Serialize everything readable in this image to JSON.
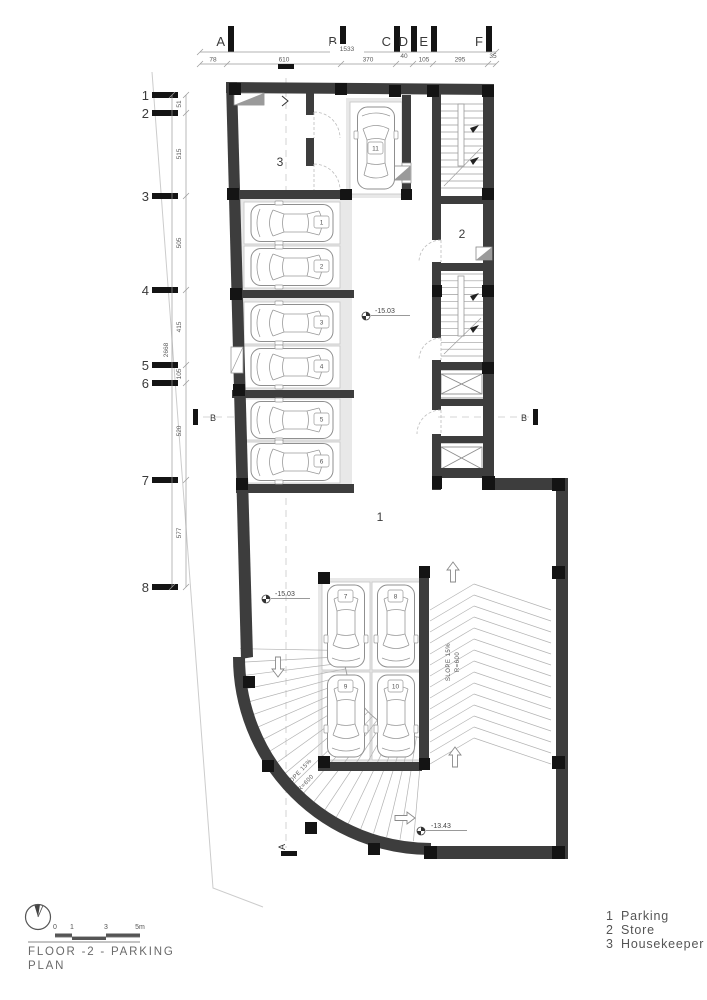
{
  "colors": {
    "wall": "#3d3d3d",
    "column": "#141414",
    "stall_bg": "#e8e8e8",
    "line": "#9a9a9a",
    "accent_text": "#3a3a3a"
  },
  "axes_top": {
    "letters": [
      "A",
      "B",
      "C",
      "D",
      "E",
      "F"
    ],
    "total": "1533",
    "segments": [
      "78",
      "610",
      "370",
      "40",
      "105",
      "295",
      "35"
    ]
  },
  "grid_left": {
    "numbers": [
      "1",
      "2",
      "3",
      "4",
      "5",
      "6",
      "7",
      "8"
    ],
    "total": "2668",
    "segments": [
      "51",
      "515",
      "505",
      "415",
      "105",
      "520",
      "577"
    ]
  },
  "rooms": {
    "parking": "1",
    "store": "2",
    "housekeeper": "3"
  },
  "spots": [
    "1",
    "2",
    "3",
    "4",
    "5",
    "6",
    "7",
    "8",
    "9",
    "10",
    "11"
  ],
  "levels": {
    "a": "-15.03",
    "b": "-15.03",
    "c": "-13.43"
  },
  "ramps": {
    "straight": {
      "line1": "SLOPE 15%",
      "line2": "R=600"
    },
    "curved": {
      "line1": "SLOPE 15%",
      "line2": "R=600"
    }
  },
  "sections": {
    "a": "A",
    "b": "B"
  },
  "scale_bar": {
    "ticks": [
      "0",
      "1",
      "3",
      "5m"
    ]
  },
  "title_block": {
    "line1": "FLOOR -2 - PARKING",
    "line2": "PLAN"
  },
  "legend": {
    "items": [
      {
        "num": "1",
        "label": "Parking"
      },
      {
        "num": "2",
        "label": "Store"
      },
      {
        "num": "3",
        "label": "Housekeeper"
      }
    ]
  }
}
